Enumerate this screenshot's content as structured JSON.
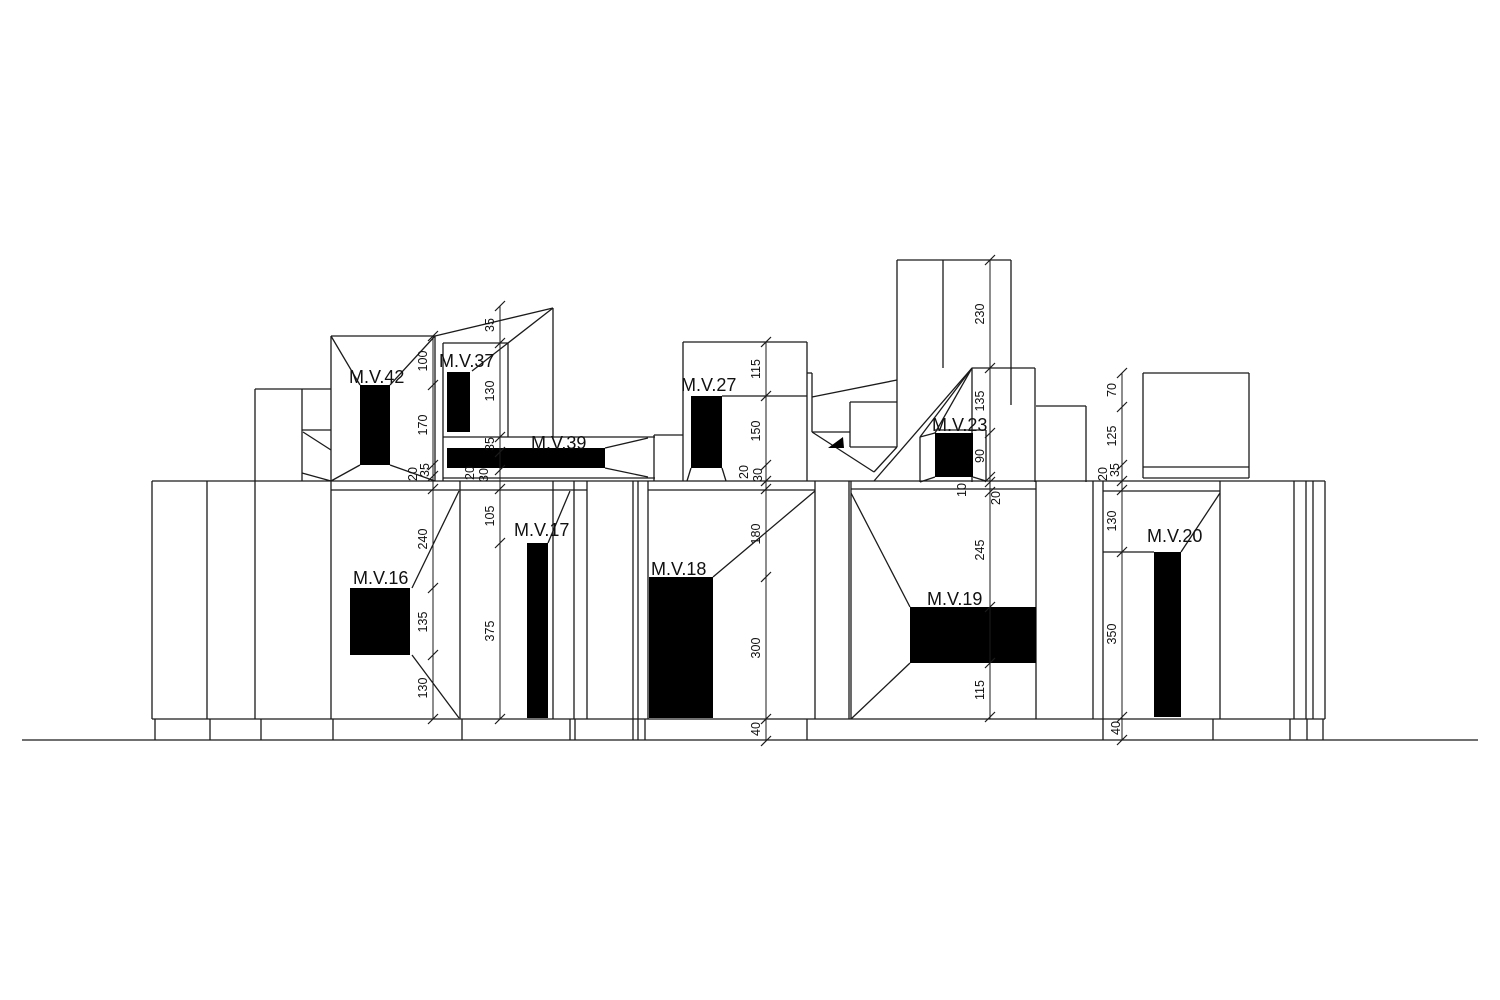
{
  "drawing": {
    "description": "Architectural facade elevation with black wall openings, M.V. opening labels and vertical dimension chains",
    "background": "#ffffff",
    "line_color": "#1b1b1b",
    "opening_fill": "#000000",
    "text_color": "#111111"
  },
  "openings": [
    {
      "id": "mv42",
      "label": "M.V.42",
      "label_x": 349,
      "label_y": 383,
      "rect": [
        360,
        385,
        30,
        80
      ]
    },
    {
      "id": "mv37",
      "label": "M.V.37",
      "label_x": 439,
      "label_y": 367,
      "rect": [
        447,
        372,
        23,
        60
      ]
    },
    {
      "id": "mv39",
      "label": "M.V.39",
      "label_x": 531,
      "label_y": 449,
      "rect": [
        447,
        448,
        158,
        20
      ]
    },
    {
      "id": "mv27",
      "label": "M.V.27",
      "label_x": 681,
      "label_y": 391,
      "rect": [
        691,
        396,
        31,
        72
      ]
    },
    {
      "id": "mv23",
      "label": "M.V.23",
      "label_x": 932,
      "label_y": 431,
      "rect": [
        935,
        433,
        38,
        44
      ]
    },
    {
      "id": "mv16",
      "label": "M.V.16",
      "label_x": 353,
      "label_y": 584,
      "rect": [
        350,
        588,
        60,
        67
      ]
    },
    {
      "id": "mv17",
      "label": "M.V.17",
      "label_x": 514,
      "label_y": 536,
      "rect": [
        527,
        543,
        21,
        175
      ]
    },
    {
      "id": "mv18",
      "label": "M.V.18",
      "label_x": 651,
      "label_y": 575,
      "rect": [
        649,
        577,
        64,
        141
      ]
    },
    {
      "id": "mv19",
      "label": "M.V.19",
      "label_x": 927,
      "label_y": 605,
      "rect": [
        910,
        607,
        126,
        56
      ]
    },
    {
      "id": "mv20",
      "label": "M.V.20",
      "label_x": 1147,
      "label_y": 542,
      "rect": [
        1154,
        552,
        27,
        165
      ]
    }
  ],
  "dimension_chains": [
    {
      "id": "chain-mv42",
      "line_x": 433,
      "items": [
        {
          "text": "100",
          "x": 427,
          "y": 361
        },
        {
          "text": "170",
          "x": 427,
          "y": 425
        },
        {
          "text": "35",
          "x": 429,
          "y": 470
        },
        {
          "text": "20",
          "x": 417,
          "y": 474
        },
        {
          "text": "240",
          "x": 427,
          "y": 539
        },
        {
          "text": "135",
          "x": 427,
          "y": 622
        },
        {
          "text": "130",
          "x": 427,
          "y": 688
        }
      ]
    },
    {
      "id": "chain-mv37",
      "line_x": 500,
      "items": [
        {
          "text": "35",
          "x": 494,
          "y": 325
        },
        {
          "text": "130",
          "x": 494,
          "y": 391
        },
        {
          "text": "35",
          "x": 494,
          "y": 444
        },
        {
          "text": "20",
          "x": 474,
          "y": 473
        },
        {
          "text": "30",
          "x": 488,
          "y": 475
        },
        {
          "text": "105",
          "x": 494,
          "y": 516
        },
        {
          "text": "375",
          "x": 494,
          "y": 631
        }
      ]
    },
    {
      "id": "chain-mv27",
      "line_x": 766,
      "items": [
        {
          "text": "115",
          "x": 760,
          "y": 369
        },
        {
          "text": "150",
          "x": 760,
          "y": 431
        },
        {
          "text": "20",
          "x": 748,
          "y": 472
        },
        {
          "text": "30",
          "x": 762,
          "y": 475
        },
        {
          "text": "180",
          "x": 760,
          "y": 534
        },
        {
          "text": "300",
          "x": 760,
          "y": 648
        },
        {
          "text": "40",
          "x": 760,
          "y": 729
        }
      ]
    },
    {
      "id": "chain-mv23",
      "line_x": 990,
      "items": [
        {
          "text": "230",
          "x": 984,
          "y": 314
        },
        {
          "text": "135",
          "x": 984,
          "y": 401
        },
        {
          "text": "90",
          "x": 984,
          "y": 456
        },
        {
          "text": "10",
          "x": 966,
          "y": 490
        },
        {
          "text": "20",
          "x": 1000,
          "y": 498
        },
        {
          "text": "245",
          "x": 984,
          "y": 550
        },
        {
          "text": "115",
          "x": 984,
          "y": 690
        }
      ]
    },
    {
      "id": "chain-mv20",
      "line_x": 1122,
      "items": [
        {
          "text": "70",
          "x": 1116,
          "y": 390
        },
        {
          "text": "125",
          "x": 1116,
          "y": 436
        },
        {
          "text": "35",
          "x": 1119,
          "y": 470
        },
        {
          "text": "20",
          "x": 1107,
          "y": 474
        },
        {
          "text": "130",
          "x": 1116,
          "y": 521
        },
        {
          "text": "350",
          "x": 1116,
          "y": 634
        },
        {
          "text": "40",
          "x": 1120,
          "y": 728
        }
      ]
    }
  ]
}
